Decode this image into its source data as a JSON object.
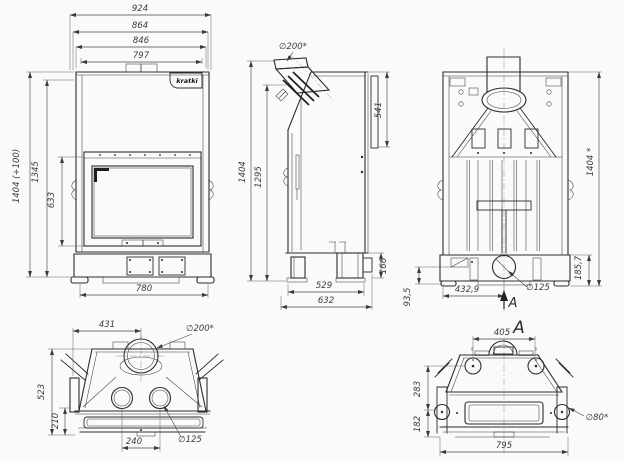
{
  "page": {
    "background": "#fafafa",
    "line_color": "#2c2c2c",
    "dim_color": "#3b3b3b"
  },
  "brand": {
    "logo_text": "kratki"
  },
  "views": {
    "front": {
      "dims": {
        "overall_width": "924",
        "width_2": "864",
        "width_3": "846",
        "width_4": "797",
        "overall_height": "1404 (+100)",
        "height_2": "1345",
        "door_height": "633",
        "base_width": "780"
      }
    },
    "side": {
      "dims": {
        "flue_diameter": "∅200*",
        "rear_panel_height": "541",
        "overall_height": "1404",
        "height_2": "1295",
        "base_height": "166",
        "depth_1": "529",
        "depth_2": "632"
      }
    },
    "rear": {
      "dims": {
        "overall_height": "1404 *",
        "base_height": "185,7",
        "outlet_offset": "432,9",
        "outlet_diameter": "∅125",
        "height_3": "93,5",
        "section_label": "A"
      }
    },
    "top": {
      "dims": {
        "flue_offset": "431",
        "flue_diameter": "∅200*",
        "depth": "523",
        "front_depth": "210",
        "outlet_spacing": "240",
        "outlet_diameter": "∅125"
      }
    },
    "section_a": {
      "label": "A",
      "dims": {
        "top_width": "405",
        "height_1": "283",
        "height_2": "182",
        "inlet_diameter": "∅80*",
        "base_width": "795"
      }
    }
  }
}
